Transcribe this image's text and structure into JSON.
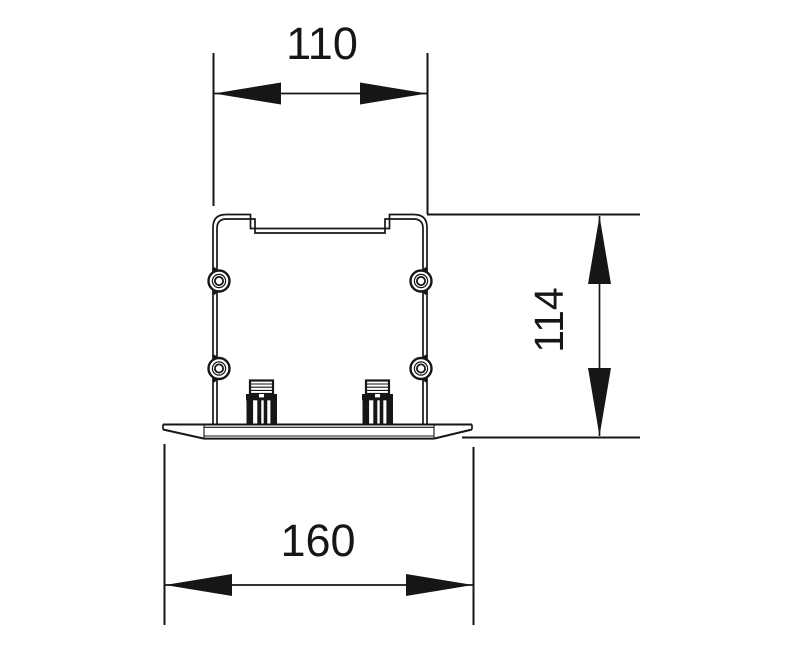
{
  "drawing": {
    "title": "mounting-bracket-section-view",
    "dimensions": {
      "width_top": {
        "value": "110"
      },
      "height_right": {
        "value": "114"
      },
      "width_bottom": {
        "value": "160"
      }
    },
    "colors": {
      "line": "#161616",
      "background": "#ffffff"
    }
  }
}
